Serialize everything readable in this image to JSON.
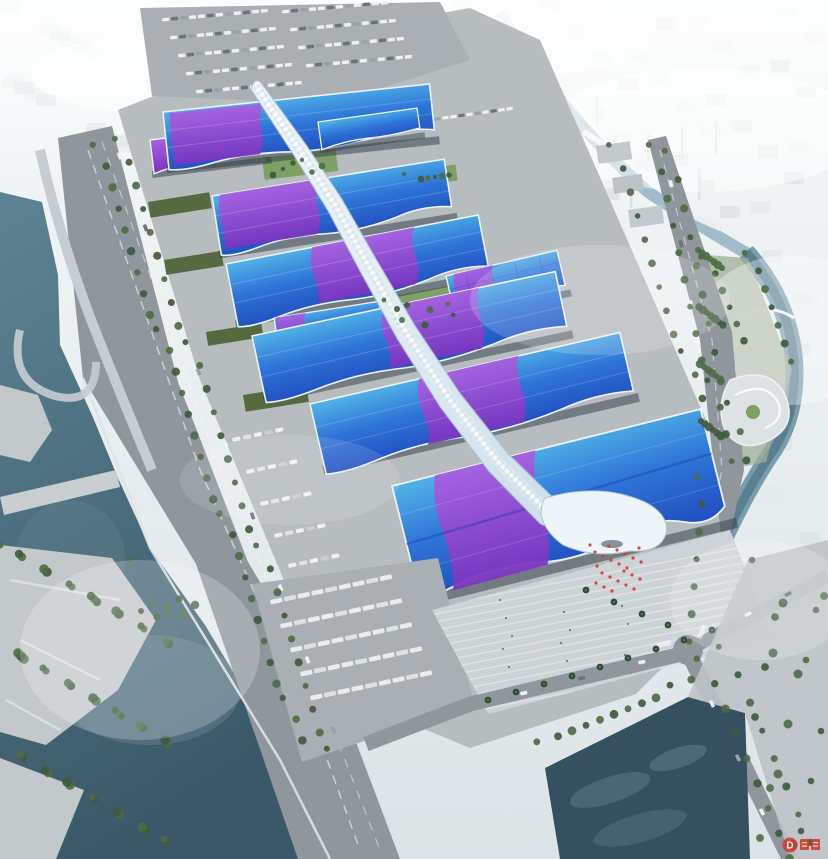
{
  "scene": {
    "description": "Aerial architectural rendering of a riverside exhibition and convention center: parallel exhibition halls with blue roofs swept by a purple ribbon, joined by a white central spine corridor ending in a wave-shaped entrance canopy, surrounded by boulevards, parking, canals, a large river, parks and a hazy white city skyline."
  },
  "watermark": {
    "badge_letter": "D"
  },
  "colors": {
    "sky_top": "#f5f8f9",
    "sky_bottom": "#dce3e6",
    "city_a": "#e0e7ea",
    "city_b": "#d2dade",
    "tower": "#f0f4f6",
    "tower_shadow": "#c9d3d8",
    "canal": "#93b2c2",
    "water_top": "#5d8494",
    "water_deep": "#3a5868",
    "pond": "#35505f",
    "pond_reflection": "#66828f",
    "river_light": "#6e93a4",
    "road": "#8f979c",
    "road_ramp": "#c6cdd2",
    "lane_mark": "#e8ecee",
    "ground": "#b7bcbf",
    "parking": "#a9afb2",
    "plaza": "#cdd3d6",
    "plaza_stripe": "#eef1f3",
    "roof_cyan": "#52b4e6",
    "roof_blue": "#2e74d8",
    "roof_deep": "#2150c0",
    "purple_light": "#a85fe0",
    "purple_deep": "#7a35c0",
    "fascia": "#e9f3f9",
    "hall_shadow": "#2e3946",
    "grid_line": "#1d4bb0",
    "spine_light": "#f2f7fa",
    "spine_mid": "#cfe0ec",
    "spine_edge": "#a9c2d4",
    "green_dark": "#3f5a3c",
    "green_mid": "#4e6b45",
    "green_roof": "#556b3f",
    "lawn": "#7fa065",
    "palm_dark": "#2f4d34",
    "palm_light": "#5a7a4a",
    "car_light": "#eef1f2",
    "car_dark": "#6c7478",
    "bus": "#e9edef",
    "red": "#d23b30",
    "bridge": "#e9eef1",
    "terrace": "#c3c8cb"
  }
}
